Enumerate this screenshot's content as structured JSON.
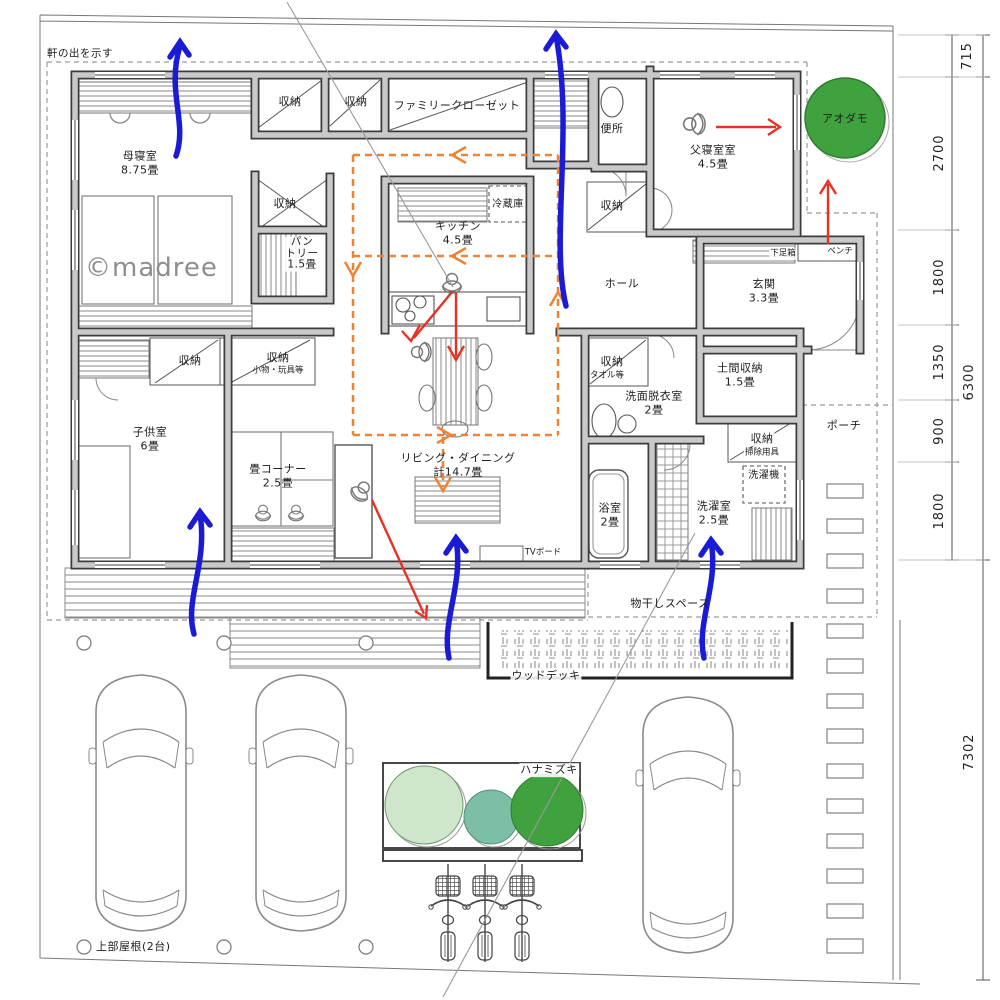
{
  "watermark": "©madree",
  "annotations": {
    "eave_note": "軒の出を示す",
    "carport_note": "上部屋根(2台)",
    "tv_board": "TVボード",
    "shoe_box": "下足箱",
    "bench": "ベンチ",
    "washer": "洗濯機",
    "refrigerator": "冷蔵庫"
  },
  "rooms": {
    "mother_bedroom": "母寝室\n8.75畳",
    "father_bedroom": "父寝室室\n4.5畳",
    "kids_room": "子供室\n6畳",
    "kitchen": "キッチン\n4.5畳",
    "pantry": "パン\nトリー\n1.5畳",
    "family_closet": "ファミリークローゼット",
    "toilet": "便所",
    "hall": "ホール",
    "genkan": "玄関\n3.3畳",
    "doma_storage": "土間収納\n1.5畳",
    "washroom": "洗面脱衣室\n2畳",
    "bath": "浴室\n2畳",
    "laundry_room": "洗濯室\n2.5畳",
    "living_dining": "リビング・ダイニング\n計14.7畳",
    "tatami_corner": "畳コーナー\n2.5畳",
    "porch": "ポーチ",
    "drying_space": "物干しスペース",
    "wood_deck": "ウッドデッキ",
    "storage": "収納",
    "storage_note_small_items": "小物・玩具等",
    "storage_note_towels": "タオル等",
    "storage_note_cleaning": "掃除用具"
  },
  "plants": {
    "aodamo": "アオダモ",
    "hanamizuki": "ハナミズキ"
  },
  "dimensions": {
    "d715": "715",
    "d2700": "2700",
    "d1800a": "1800",
    "d1350": "1350",
    "d900": "900",
    "d1800b": "1800",
    "d6300": "6300",
    "d7302": "7302"
  },
  "colors": {
    "wind_arrow": "#1b1bd6",
    "sight_arrow": "#e53225",
    "circulation": "#f08231",
    "tree_dark_green": "#3fa23f",
    "tree_light_green": "#cfe5cc",
    "tree_teal": "#7cbfa5",
    "wall_fill": "#c9c9c9",
    "wall_edge": "#3c3c3c"
  }
}
